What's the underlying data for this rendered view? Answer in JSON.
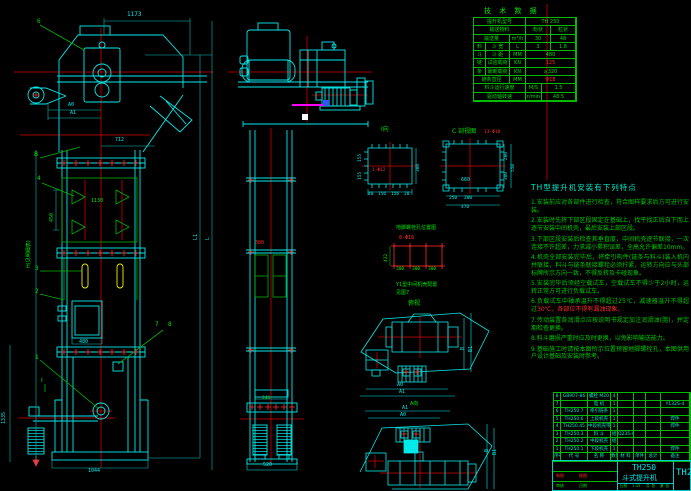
{
  "colors": {
    "bg": "#000000",
    "line_cyan": "#00eaea",
    "line_green": "#00e400",
    "line_red": "#ff2a2a",
    "line_yellow": "#f0f000",
    "line_magenta": "#ff00ff",
    "line_white": "#ffffff"
  },
  "tech": {
    "title": "技 术 数 据",
    "rows": [
      [
        {
          "t": "提升机型号",
          "w": 52
        },
        {
          "t": "TH 250",
          "w": 50
        }
      ],
      [
        {
          "t": "输送物料",
          "w": 52
        },
        {
          "t": "粉状",
          "w": 25
        },
        {
          "t": "粒状",
          "w": 25
        }
      ],
      [
        {
          "t": "输送量",
          "w": 36
        },
        {
          "t": "m³/h",
          "w": 16
        },
        {
          "t": "30",
          "w": 25
        },
        {
          "t": "48",
          "w": 25
        }
      ],
      [
        {
          "t": "料",
          "w": 12
        },
        {
          "t": "斗 宽",
          "w": 24
        },
        {
          "t": "L",
          "w": 16
        },
        {
          "t": "3",
          "w": 25
        },
        {
          "t": "1.8",
          "w": 25
        }
      ],
      [
        {
          "t": "斗",
          "w": 12
        },
        {
          "t": "斗 距",
          "w": 24
        },
        {
          "t": "MM",
          "w": 16
        },
        {
          "t": "480",
          "w": 50
        }
      ],
      [
        {
          "t": "链",
          "w": 12
        },
        {
          "t": "试验载荷",
          "w": 24
        },
        {
          "t": "KN",
          "w": 16
        },
        {
          "t": "125",
          "w": 50,
          "c": "r"
        }
      ],
      [
        {
          "t": "条",
          "w": 12
        },
        {
          "t": "破断载荷",
          "w": 24
        },
        {
          "t": "KN",
          "w": 16
        },
        {
          "t": "≥320",
          "w": 50
        }
      ],
      [
        {
          "t": "链条直径",
          "w": 36
        },
        {
          "t": "MM",
          "w": 16
        },
        {
          "t": "Φ18",
          "w": 50,
          "c": "r"
        }
      ],
      [
        {
          "t": "料斗运行速度",
          "w": 52
        },
        {
          "t": "M/S",
          "w": 16
        },
        {
          "t": "1.5",
          "w": 34
        }
      ],
      [
        {
          "t": "驱动轴转速",
          "w": 52
        },
        {
          "t": "r/min",
          "w": 16
        },
        {
          "t": "48.5",
          "w": 34
        }
      ]
    ]
  },
  "notes": {
    "title": "TH型提升机安装有下列特点",
    "items": [
      {
        "t": "1.安装前应对各部件进行检查，符合图样要求后方可进行安装。"
      },
      {
        "t": "2.安装时先将下部区段固定在基础上，找平找正后自下而上逐节安装中间机壳，最后安装上部区段。"
      },
      {
        "t": "3.下部区段安装后检查其垂直度，中间机壳逐节联接，一次连接不许超差，力求减小累积误差，全高允许偏差10mm。"
      },
      {
        "t": "4.机壳全部安装完毕后，将牵引构件(链条与料斗)装入机内并联接，料斗与链条联接螺栓必须拧紧，运转方向应与头部标牌所示方向一致，不得反转及卡碰现象。"
      },
      {
        "t": "5.安装完毕后须经空载试车，空载试车不得少于2小时，运转正常方可进行负载试车。"
      },
      {
        "t": "6.负载试车中轴承温升不得超过25℃，减速器温升不得超过",
        "red": "30℃，各部位不得有漏油现象。"
      },
      {
        "t": "7.传动装置各润滑点应按说明书规定加注润滑油(脂)，并定期检查更换。"
      },
      {
        "t": "8.料斗磨损严重时应及时更换，以免影响输送能力。"
      },
      {
        "t": "9.基础施工时请按本图所示位置预留地脚螺栓孔，本图供用户设计基础及安装时参考。"
      }
    ]
  },
  "bom": {
    "cols": [
      7,
      27,
      23,
      7,
      16,
      12,
      15,
      29
    ],
    "rows": [
      [
        "8",
        "GB907-86",
        "螺栓 M20",
        "4",
        "",
        "",
        "",
        ""
      ],
      [
        "7",
        "",
        "电 机",
        "1",
        "",
        "",
        "",
        "Y132S-4"
      ],
      [
        "6",
        "TH250.7",
        "牵引链条",
        "1",
        "",
        "",
        "",
        ""
      ],
      [
        "5",
        "TH250.6",
        "上段机壳",
        "1",
        "",
        "",
        "",
        "焊件"
      ],
      [
        "4",
        "TH250.45",
        "中段机壳带门",
        "1",
        "",
        "",
        "",
        "焊件"
      ],
      [
        "3",
        "TH250.3",
        "料 斗",
        "组",
        "Q235-A",
        "",
        "",
        ""
      ],
      [
        "2",
        "TH250.2",
        "中段机壳",
        "组",
        "",
        "",
        "",
        ""
      ],
      [
        "1",
        "TH250.1",
        "下段机壳",
        "1",
        "",
        "",
        "",
        "焊件"
      ]
    ],
    "header": [
      "序号",
      "代  号",
      "名  称",
      "数量",
      "材  料",
      "单件",
      "总计",
      "备注"
    ]
  },
  "tb": {
    "model": "TH250",
    "product": "斗式提升机",
    "model2": "TH250",
    "scale_l": "比例",
    "scale_v": "1:25",
    "sheet1": "共 张",
    "sheet2": "第 张",
    "sig": [
      {
        "t": "制图",
        "c": "r"
      },
      {
        "t": "描图",
        "c": "r"
      },
      {
        "t": "审核",
        "c": "g"
      },
      {
        "t": "日期",
        "c": "g"
      }
    ]
  },
  "dims": {
    "d1173": "1173",
    "a0": "A0",
    "a1": "A1",
    "d712": "712",
    "d450": "450",
    "d1130": "1130",
    "d480": "480",
    "d1335": "1335",
    "d1044": "1044",
    "d520": "520",
    "d144": "144",
    "d380": "380",
    "H": "H(见明细表)",
    "L": "L",
    "L1": "L1"
  },
  "balloons": {
    "b1": "1",
    "b2": "2",
    "b3": "3",
    "b4": "4",
    "b6": "6",
    "b7": "7",
    "b8": "8",
    "B": "B",
    "I": "Ⅰ"
  },
  "di": {
    "title": "Ⅰ向",
    "hole": "1-Φ12",
    "r": "300",
    "l1": "155",
    "l2": "155",
    "b1": "40",
    "b2": "156",
    "b3": "156",
    "b4": "20"
  },
  "dc": {
    "title": "C 剖视图",
    "hole": "13-Φ18",
    "c": "660",
    "b1": "250",
    "b2": "200",
    "bt": "470",
    "r1": "200",
    "r2": "300",
    "rt": "550"
  },
  "an": {
    "title": "地脚螺栓孔位置图",
    "hole": "8-Φ18",
    "l": "432",
    "b1": "300",
    "b2": "300",
    "b3": "300",
    "s1": "Y1型中间机壳配置",
    "s2": "见图7",
    "v": "俯视"
  },
  "st": {
    "a0": "A0",
    "a1": "A1",
    "b": "B",
    "b1": "B1"
  },
  "sb": {
    "v": "A向",
    "a1": "A1",
    "a0": "A0",
    "b": "B",
    "b1": "B1"
  }
}
